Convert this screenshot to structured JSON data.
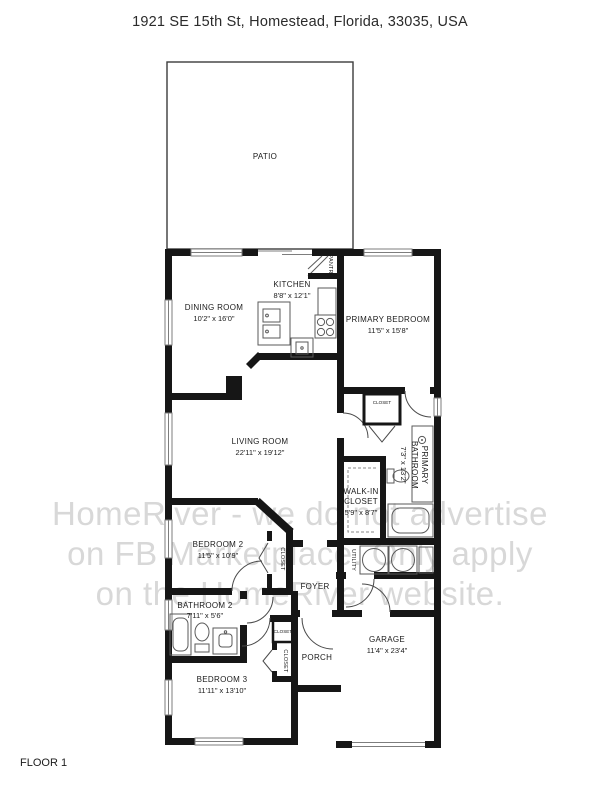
{
  "title": "1921 SE 15th St, Homestead, Florida, 33035, USA",
  "floor_label": "FLOOR 1",
  "watermark": {
    "line1": "HomeRiver - we do not advertise",
    "line2": "on FB Marketplace. Only apply",
    "line3": "on the HomeRiver website."
  },
  "rooms": {
    "patio": {
      "name": "PATIO"
    },
    "dining_room": {
      "name": "DINING ROOM",
      "dims": "10'2\" x 16'0\""
    },
    "kitchen": {
      "name": "KITCHEN",
      "dims": "8'8\" x 12'1\""
    },
    "pantry": {
      "name": "PANTRY"
    },
    "primary_bedroom": {
      "name": "PRIMARY BEDROOM",
      "dims": "11'5\" x 15'8\""
    },
    "living_room": {
      "name": "LIVING ROOM",
      "dims": "22'11\" x 19'12\""
    },
    "primary_bathroom": {
      "name_line1": "PRIMARY",
      "name_line2": "BATHROOM",
      "dims": "7'3\" x 13'2\""
    },
    "walk_in_closet": {
      "name_line1": "WALK-IN",
      "name_line2": "CLOSET",
      "dims": "5'9\" x 8'7\""
    },
    "hall_closet": {
      "name": "CLOSET"
    },
    "utility": {
      "name": "UTILITY"
    },
    "foyer": {
      "name": "FOYER"
    },
    "bedroom_2": {
      "name": "BEDROOM 2",
      "dims": "11'5\" x 10'9\""
    },
    "bedroom_2_closet": {
      "name": "CLOSET"
    },
    "bathroom_2": {
      "name": "BATHROOM 2",
      "dims": "7'11\" x 5'6\""
    },
    "bedroom_3": {
      "name": "BEDROOM 3",
      "dims": "11'11\" x 13'10\""
    },
    "bedroom_3_closet": {
      "name": "CLOSET"
    },
    "entry_closet": {
      "name": "CLOSET"
    },
    "porch": {
      "name": "PORCH"
    },
    "garage": {
      "name": "GARAGE",
      "dims": "11'4\" x 23'4\""
    }
  },
  "colors": {
    "wall": "#161616",
    "fixture_line": "#5a5a5a",
    "watermark": "#d8d8d8"
  }
}
